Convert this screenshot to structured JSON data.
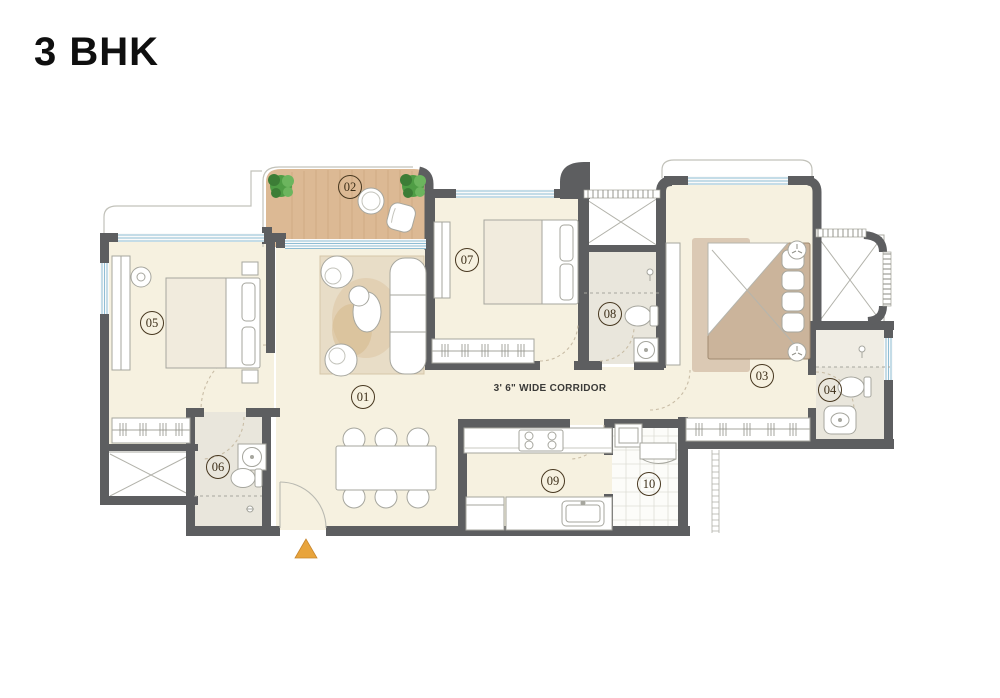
{
  "title": "3 BHK",
  "corridor_label": "3' 6\" WIDE CORRIDOR",
  "rooms": [
    {
      "number": "01"
    },
    {
      "number": "02"
    },
    {
      "number": "03"
    },
    {
      "number": "04"
    },
    {
      "number": "05"
    },
    {
      "number": "06"
    },
    {
      "number": "07"
    },
    {
      "number": "08"
    },
    {
      "number": "09"
    },
    {
      "number": "10"
    }
  ],
  "colors": {
    "wall": "#5d5e60",
    "floor": "#f6f1e0",
    "bathroom_floor": "#e9e6dc",
    "balcony_wood": "#dcb994",
    "utility_tile": "#fcfcf9",
    "window_glass": "#8fbdd4",
    "entrance_arrow": "#e8a43c",
    "label_ink": "#47371f",
    "plant_green": "#4f9d45"
  }
}
